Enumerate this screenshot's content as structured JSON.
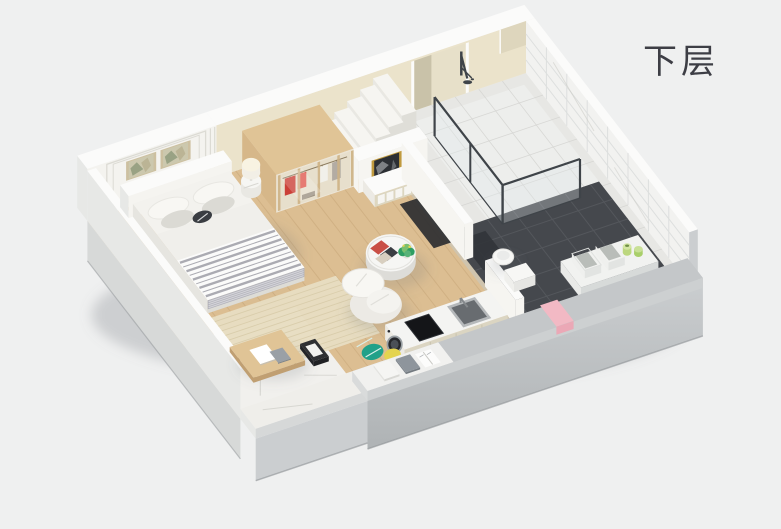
{
  "label": "下层",
  "scene_type": "isometric-3d-floorplan-render",
  "objects": [
    "bed",
    "pillows",
    "headboard-wall-art",
    "panel-wall",
    "wardrobe",
    "nightstand",
    "table-lamp",
    "staircase",
    "stair-wall-art",
    "sideboard",
    "area-rug",
    "balcony-marble-floor",
    "balcony-desk",
    "coffee-table",
    "magazines",
    "potted-plant",
    "lounge-chair",
    "floor-cushions",
    "ledge-books",
    "kitchen-counter",
    "washing-machine",
    "cooktop",
    "kitchen-sink",
    "bathroom",
    "shower-enclosure",
    "shower-head",
    "toilet",
    "vanity-shelf",
    "storage-bins",
    "bottles",
    "pink-towel",
    "floor-label"
  ],
  "palette": {
    "bg": "#eff0f0",
    "labelColor": "#3d3e45",
    "wood": "#dcbe92",
    "woodLine": "#c2a173",
    "marble": "#f1f0ed",
    "marbleVein": "#c8c8c2",
    "cream": "#ebe3cb",
    "creamRecess": "#e7e0c9",
    "recessShade": "#c9c2a9",
    "niche": "#ded6bd",
    "white": "#f6f5f1",
    "wallTop": "#fbfbfa",
    "panelWall": "#f4f3ef",
    "panelLine": "#dcdbd4",
    "paleOuter": "#e7e8e6",
    "paleOuterLow": "#d7d9d8",
    "grayOuter": "#cbced0",
    "grayOuterDeep": "#afb3b5",
    "edgeDark": "#8f9396",
    "grayTop": "#c4c7c9",
    "bathDark": "#45484d",
    "bathLine": "#54575c",
    "tileLight": "#e7e7e4",
    "tileLine": "#d3d3d0",
    "showerTile": "#edeeec",
    "threshold": "#cfc4ae",
    "marbleWall": "#f2f2f0",
    "marbleWallLine": "#dddfde",
    "glass": "rgba(226,233,236,0.38)",
    "glassSide": "rgba(222,229,233,0.30)",
    "frameDark": "#3f4449",
    "gold": "#c09a3e",
    "artDark": "#2c2f34",
    "artStreak": "#cfd3d6",
    "framePale": "#cdc0a0",
    "artPale": "#ccc8ae",
    "artGreen": "#99a284",
    "artGreen2": "#b7af8f",
    "red": "#cb4038",
    "red2": "#e05a50",
    "shirt": "#f1f0ea",
    "coat": "#b3aca3",
    "woodFurn": "#d6b789",
    "woodFurnTop": "#e0c496",
    "woodFurnDark": "#c09f72",
    "legDark": "#5e5245",
    "bedWhite": "#f3f2ee",
    "bedSide": "#e6e5e0",
    "bedFront": "#dddcd6",
    "headboard": "#f5f4f0",
    "duvet": "#f0efeb",
    "blanket": "#a3a3ab",
    "blanketDrape": "#b1b1b9",
    "pillowWhite": "#f8f7f3",
    "pillowGray": "#dbdad4",
    "pillowDark": "#3a3d42",
    "rug": "#e7ddc1",
    "rugLine": "#d5c8a5",
    "plant": "#2f9e63",
    "plantLight": "#7cc06f",
    "yellow": "#e4d44f",
    "teal": "#21a189",
    "steel": "#b6b9bb",
    "steelDark": "#686c70",
    "black": "#141518",
    "pink": "#f2b9c4",
    "pinkDeep": "#eba8b6",
    "washerDoor": "#26282c",
    "washerRing": "#9aa0a4",
    "washerInner": "#4a5057",
    "counterTop": "#f4f4f2",
    "counterFace": "#dbd5c2",
    "counterSeam": "#c9c3ae",
    "counterEnd": "#eceae4",
    "sideboardFace": "#ded7c0",
    "doorWhite": "#f6f5f1",
    "shadow": "rgba(110,115,120,0.20)",
    "buildingShadow": "rgba(125,130,135,0.30)",
    "stepTop": "#f6f5f1",
    "stepFace": "#e9e8e3",
    "stepSide": "#dfded8",
    "lampShade": "#f2efe6",
    "lampGlow": "#f8f3e2"
  }
}
